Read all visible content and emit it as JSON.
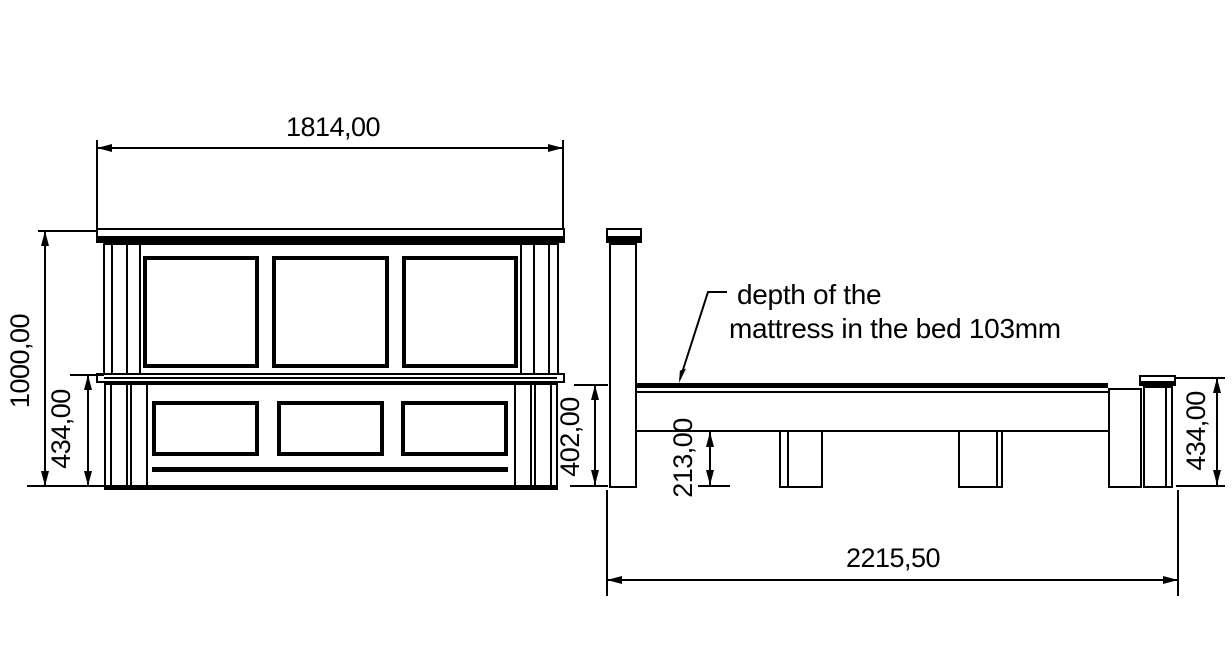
{
  "front_view": {
    "width_label": "1814,00",
    "height_label": "1000,00",
    "footboard_height_label": "434,00"
  },
  "side_view": {
    "platform_height_label": "402,00",
    "underbed_clearance_label": "213,00",
    "footboard_height_label": "434,00",
    "length_label": "2215,50"
  },
  "annotation": {
    "line1": "depth of the",
    "line2": "mattress in the bed 103mm"
  },
  "colors": {
    "line": "#000000",
    "background": "#ffffff"
  }
}
